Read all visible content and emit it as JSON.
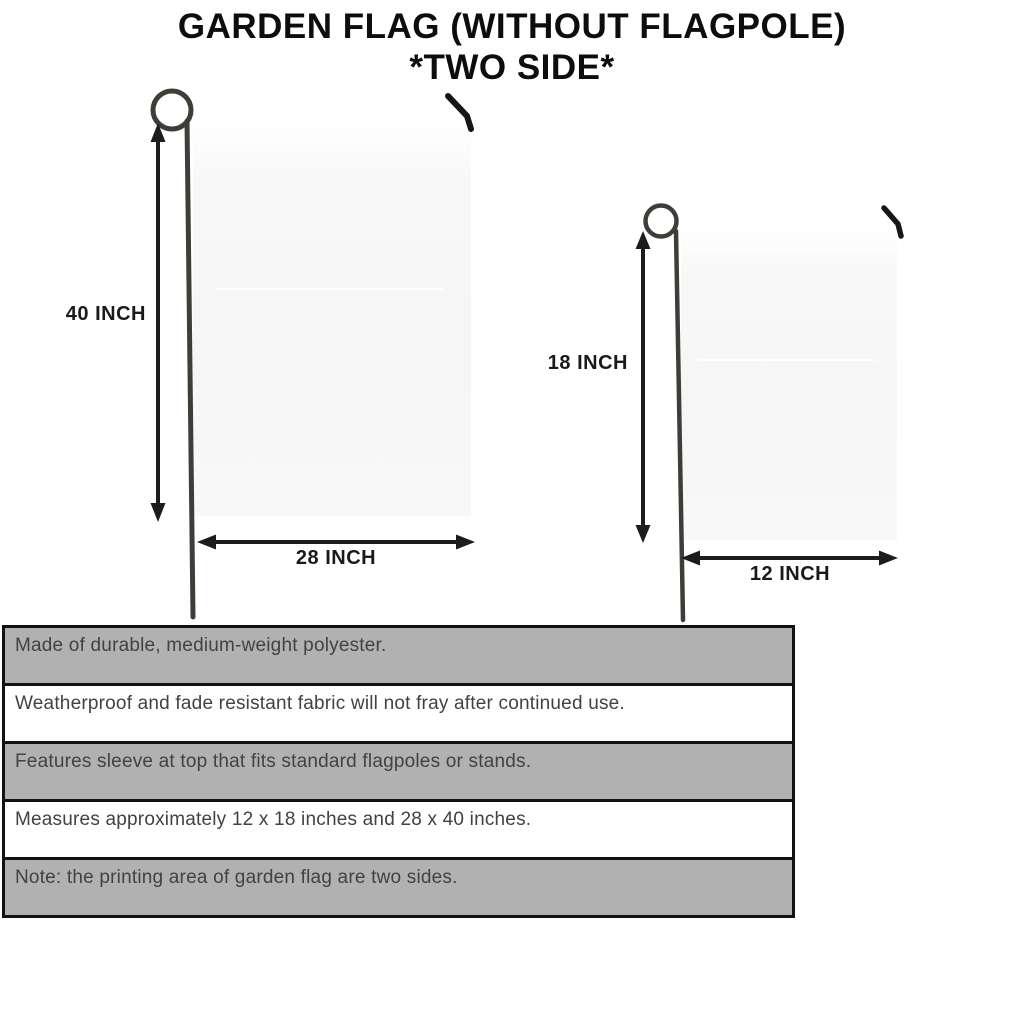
{
  "title": {
    "line1": "GARDEN FLAG (WITHOUT FLAGPOLE)",
    "line2": "*TWO SIDE*"
  },
  "flags": {
    "large": {
      "height_label": "40 INCH",
      "width_label": "28 INCH"
    },
    "small": {
      "height_label": "18 INCH",
      "width_label": "12 INCH"
    }
  },
  "features": [
    "Made of durable, medium-weight polyester.",
    "Weatherproof and fade resistant fabric will not fray after continued use.",
    "Features sleeve at top that fits standard flagpoles or stands.",
    "Measures approximately 12 x 18 inches and 28 x 40 inches.",
    "Note: the printing area of garden flag are two sides."
  ],
  "colors": {
    "row_gray": "#b1b1b1",
    "row_white": "#ffffff",
    "flag_fill": "#f7f7f7",
    "pole": "#3e3e39",
    "arrow": "#1c1c1c",
    "border": "#121212",
    "title_color": "#0d0d0d",
    "table_text": "#424242"
  }
}
